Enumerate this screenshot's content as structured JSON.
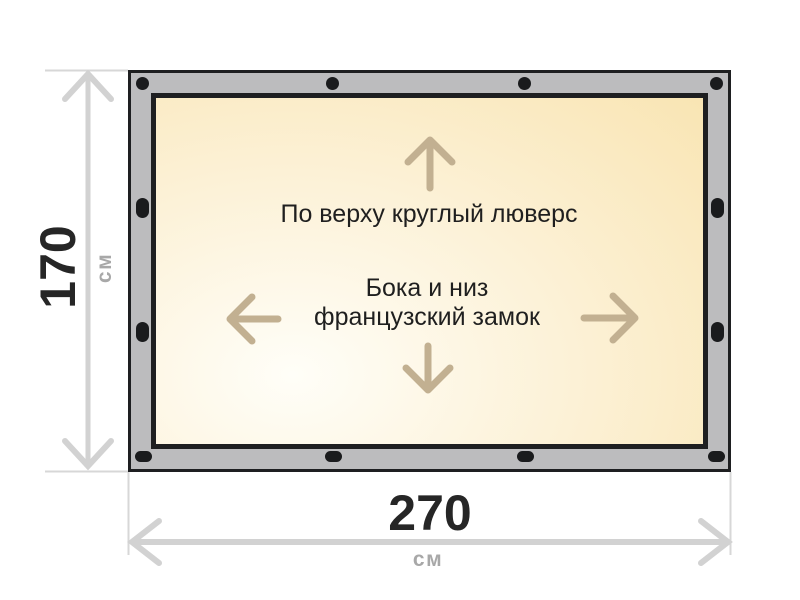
{
  "diagram": {
    "type": "product-dimension-diagram",
    "product": "banner-tarpaulin"
  },
  "dimensions": {
    "height": {
      "value": "170",
      "unit": "см"
    },
    "width": {
      "value": "270",
      "unit": "см"
    }
  },
  "notes": {
    "top": "По верху круглый люверс",
    "middle_line1": "Бока и низ",
    "middle_line2": "французский замок"
  },
  "fasteners": {
    "top": {
      "shape": "round",
      "count": 4
    },
    "left": {
      "shape": "oval-vertical",
      "count": 2
    },
    "right": {
      "shape": "oval-vertical",
      "count": 2
    },
    "bottom": {
      "shape": "oval-horizontal",
      "count": 4
    }
  },
  "colors": {
    "frame_gray": "#bcbcbe",
    "border_dark": "#1e1f21",
    "panel_light": "#fffef8",
    "panel_mid": "#fcf1d6",
    "panel_cream": "#f8e2ab",
    "arrow_tan": "#c2b091",
    "dim_line": "#d2d2d2",
    "ext_line": "#d7d7d7",
    "label_dark": "#262626",
    "unit_gray": "#a8a8a8",
    "text_dark": "#1f1f1f"
  }
}
